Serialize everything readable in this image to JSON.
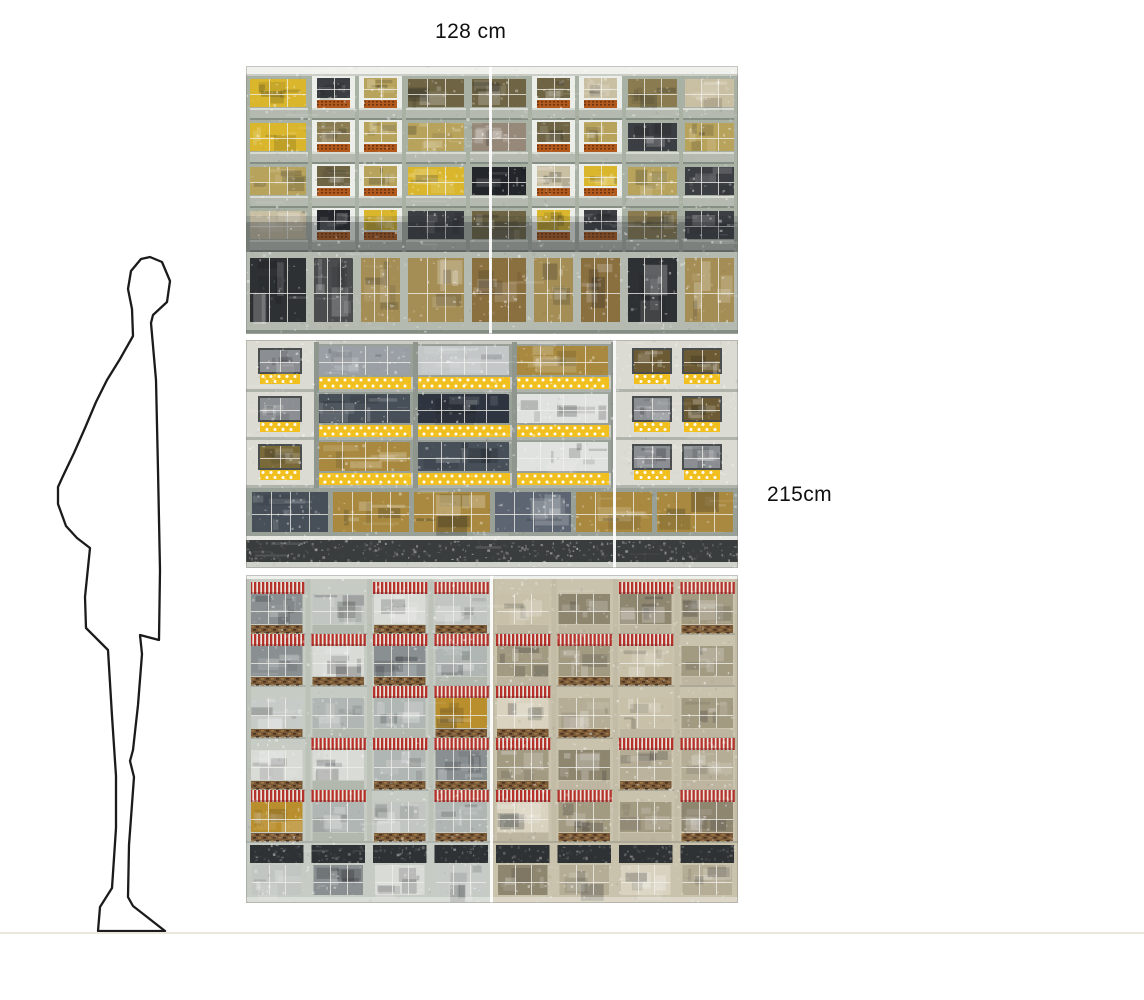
{
  "dimension_labels": {
    "width": "128 cm",
    "height": "215cm"
  },
  "scale_figure": {
    "label": "human silhouette scale reference",
    "stroke_color": "#1b1b1b",
    "points": "150,257 162,262 170,281 167,302 153,315 151,323 156,380 158,470 160,570 159,640 140,635 142,654 138,705 133,750 130,761 134,777 129,845 128,897 133,906 165,931 98,931 100,907 112,888 116,828 116,776 112,716 108,650 86,628 85,597 90,548 77,538 66,526 58,504 58,487 63,476 74,453 85,428 96,402 107,380 120,359 133,336 132,309 128,289 131,271 141,259"
  },
  "floor_line": {
    "color": "#ebe7df"
  },
  "artwork": {
    "description": "triptych collage of modernist apartment facades",
    "panels": [
      {
        "id": "top-facade",
        "kind": "brick",
        "accent": "brick-orange spandrels",
        "seed": 11,
        "bg": "#e9eae5",
        "plaster": "#eceee9",
        "frame": "#a9b0a4",
        "sill": "#b4bab0",
        "sill_dark": "#858e84",
        "sill_lite": "#d8dbd3",
        "brick": "#b25a1e",
        "brick_dot": "#6e3410",
        "shadow": "rgba(40,46,50,0.40)",
        "glass": [
          "#8a7c50",
          "#b8a35c",
          "#3b3e42",
          "#c9bfa2",
          "#d9b62c",
          "#6f6544",
          "#23262b",
          "#97897a"
        ],
        "glass_bottom": [
          "#8a6f3f",
          "#2e3134",
          "#c5b793",
          "#6e6148",
          "#4a4c4e",
          "#a58e56"
        ]
      },
      {
        "id": "middle-facade",
        "kind": "dots",
        "accent": "yellow polka-dot awnings",
        "seed": 22,
        "bg": "#c9cbc4",
        "bg_end": "#dcdbd3",
        "frame": "#99a098",
        "post": "#8f968e",
        "yellow": "#f2c01e",
        "dark_band": "#3a3d3d",
        "small_frame": "#4a4e4e",
        "glass": [
          "#5c6571",
          "#2f3540",
          "#c3c7c8",
          "#a8893f",
          "#9aa0a6",
          "#e0e2df",
          "#474f58"
        ],
        "glass_small": [
          "#6b5a33",
          "#3a3f45",
          "#8b8f93",
          "#7a6a3a"
        ]
      },
      {
        "id": "bottom-facade",
        "kind": "awning",
        "accent": "red striped awnings and wicker balustrades",
        "seed": 33,
        "bg_left": "#c6ccc3",
        "bg_right": "#c9c2ac",
        "post_left": "#bcc2b8",
        "post_right": "#c2bba6",
        "red": "#b5322c",
        "awning_bg": "#eae5da",
        "wicker": "#7a5a38",
        "wicker_dark": "#4a331e",
        "wicker_lite": "#9c7848",
        "lintel": "#2e3234",
        "glass_left": [
          "#c6cbc8",
          "#b0b6b4",
          "#d9dbd7",
          "#989e9e",
          "#8a9092",
          "#c2c6c2"
        ],
        "glass_right": [
          "#c8c0a8",
          "#b5ad96",
          "#d8d2bf",
          "#a39a82",
          "#8f8670"
        ],
        "glass_rare": [
          "#3c4144",
          "#b98f2e"
        ]
      }
    ]
  }
}
